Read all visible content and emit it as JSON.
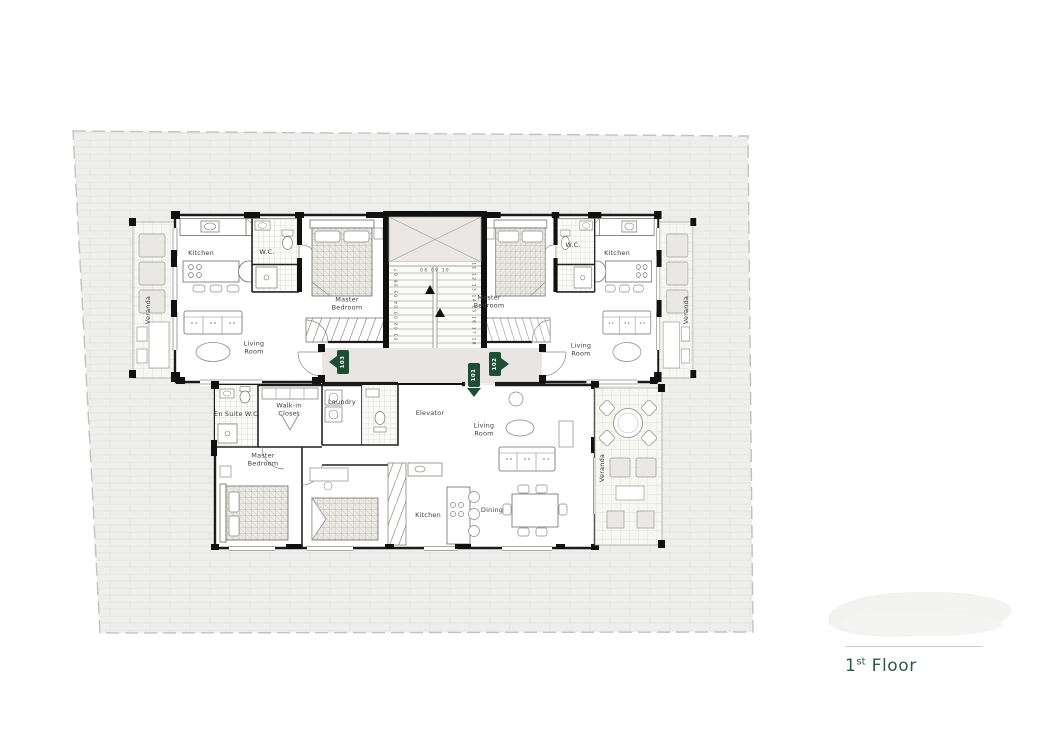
{
  "plan": {
    "unit_103": {
      "marker": "103",
      "kitchen": "Kitchen",
      "wc": "W.C.",
      "master_bedroom": "Master\nBedroom",
      "living_room": "Living\nRoom",
      "veranda": "Veranda"
    },
    "unit_102": {
      "marker": "102",
      "kitchen": "Kitchen",
      "wc": "W.C.",
      "master_bedroom": "Master\nBedroom",
      "living_room": "Living\nRoom",
      "veranda": "Veranda"
    },
    "unit_101": {
      "marker": "101",
      "en_suite_wc": "En Suite W.C.",
      "walk_in_closet": "Walk-in\nCloset",
      "laundry": "Laundry",
      "master_bedroom": "Master\nBedroom",
      "living_room": "Living\nRoom",
      "dining": "Dining",
      "kitchen": "Kitchen",
      "veranda": "Veranda"
    },
    "core": {
      "elevator": "Elevator",
      "stairs_flight_up": "01 02 03 04 05 06 07",
      "stairs_landing": "08 09 10",
      "stairs_flight_down": "11 12 13 14 15 16 17 18"
    }
  },
  "footer": {
    "floor_number": "1",
    "floor_ordinal": "st",
    "floor_word": "Floor"
  },
  "colors": {
    "unit_marker_green": "#1e4c34",
    "floor_label_green": "#2f5a44",
    "site_fill": "#eeeeec",
    "corridor_fill": "#e9e5e2"
  }
}
